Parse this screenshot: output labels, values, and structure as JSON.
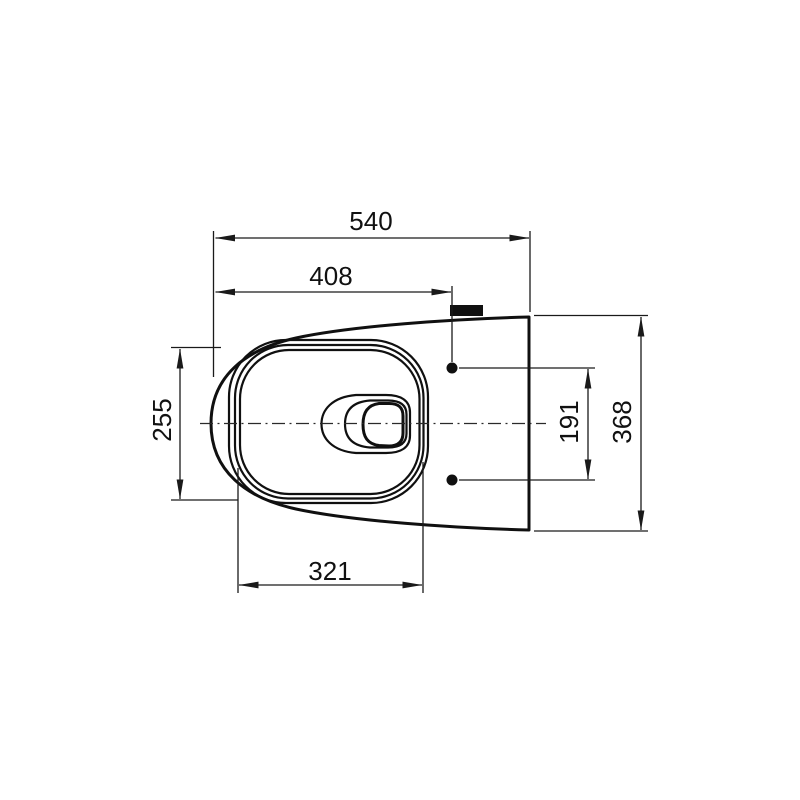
{
  "dims": {
    "top_outer": "540",
    "top_inner": "408",
    "left": "255",
    "bottom": "321",
    "right_inner": "191",
    "right_outer": "368"
  }
}
